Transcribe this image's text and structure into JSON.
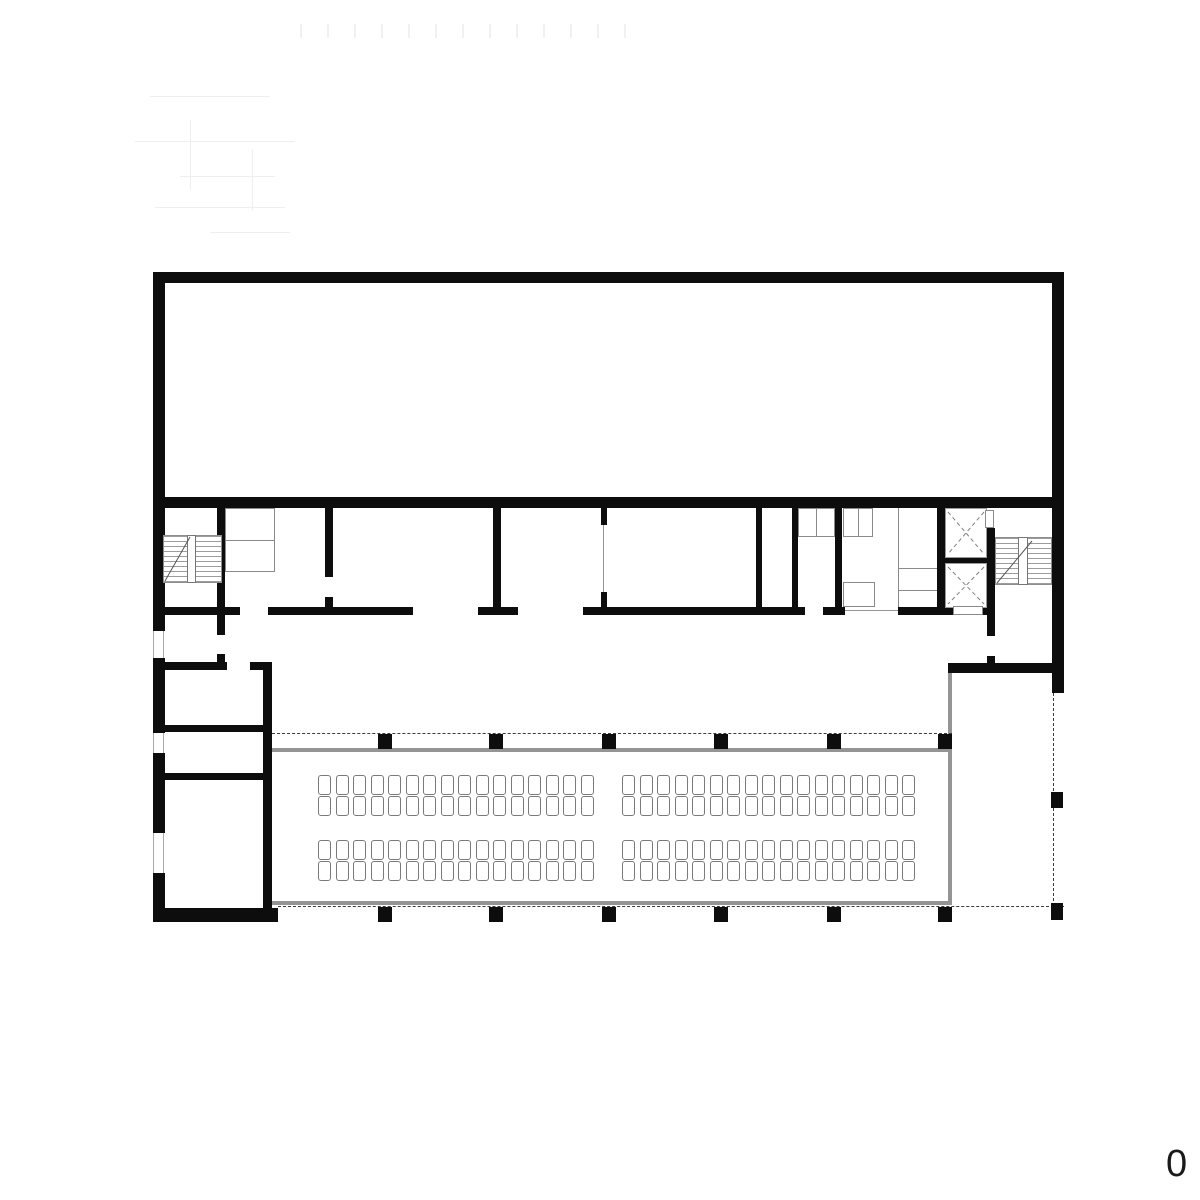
{
  "drawing": {
    "floor_label": "0"
  },
  "colors": {
    "wall": "#0d0d0d",
    "line_gray": "#949494",
    "fixture": "#8a8a8a",
    "dash": "#3c3c3c",
    "seat_border": "#7a7a7a",
    "label": "#1a1a1a"
  },
  "auditorium": {
    "seat_rows_y": [
      775,
      796,
      840,
      861
    ],
    "seat_groups": [
      {
        "x": 318,
        "cols": 16
      },
      {
        "x": 622,
        "cols": 17
      }
    ],
    "seat_pitch": 17.5,
    "seat_width": 13,
    "seat_height": 20,
    "seats_total": 132
  },
  "colonnade": {
    "pillar_xs": [
      378,
      489,
      602,
      714,
      827,
      938
    ],
    "top_row_y": 734,
    "bottom_row_y": 907,
    "pillar_w": 14,
    "pillar_h": 15,
    "extra_pillars": [
      {
        "x": 1051,
        "y": 792,
        "w": 12,
        "h": 16
      },
      {
        "x": 1051,
        "y": 903,
        "w": 12,
        "h": 17
      }
    ]
  }
}
